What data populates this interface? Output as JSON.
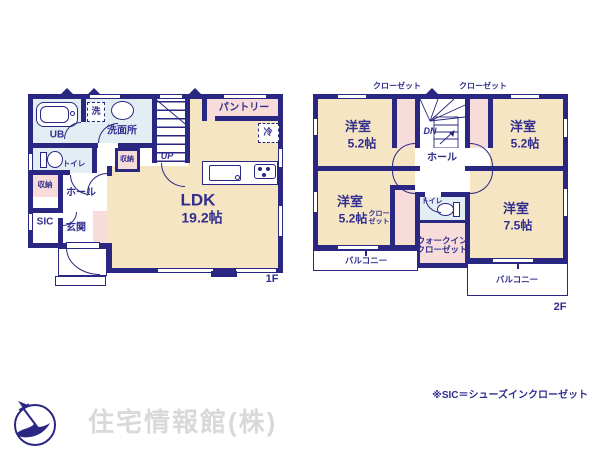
{
  "colors": {
    "wall": "#2a2782",
    "ink": "#312e8f",
    "cream": "#f6e5c3",
    "pink": "#f8dcd9",
    "blue": "#e2edf4",
    "paper": "#ffffff",
    "wm": "#d9d9d9"
  },
  "floor1": {
    "floor_label": "1F",
    "labels": {
      "ub": "UB",
      "washer": "洗",
      "washroom": "洗面所",
      "pantry": "パントリー",
      "fridge": "冷",
      "up": "UP",
      "toilet": "トイレ",
      "storage_a": "収納",
      "storage_b": "収納",
      "hall": "ホール",
      "sic": "SIC",
      "entrance": "玄関",
      "ldk": "LDK",
      "ldk_size": "19.2帖"
    }
  },
  "floor2": {
    "floor_label": "2F",
    "labels": {
      "closet_top_left": "クローゼット",
      "closet_top_right": "クローゼット",
      "dn": "DN",
      "hall": "ホール",
      "bed_tl": "洋室",
      "bed_tl_size": "5.2帖",
      "bed_tr": "洋室",
      "bed_tr_size": "5.2帖",
      "bed_bl": "洋室",
      "bed_bl_size": "5.2帖",
      "bed_br": "洋室",
      "bed_br_size": "7.5帖",
      "closet_line1": "クロー",
      "closet_line2": "ゼット",
      "toilet": "トイレ",
      "wic_line1": "ウォークイン",
      "wic_line2": "クローゼット",
      "balcony_left": "バルコニー",
      "balcony_right": "バルコニー"
    }
  },
  "footer": {
    "note": "※SIC＝シューズインクローゼット",
    "company": "住宅情報館(株)"
  }
}
